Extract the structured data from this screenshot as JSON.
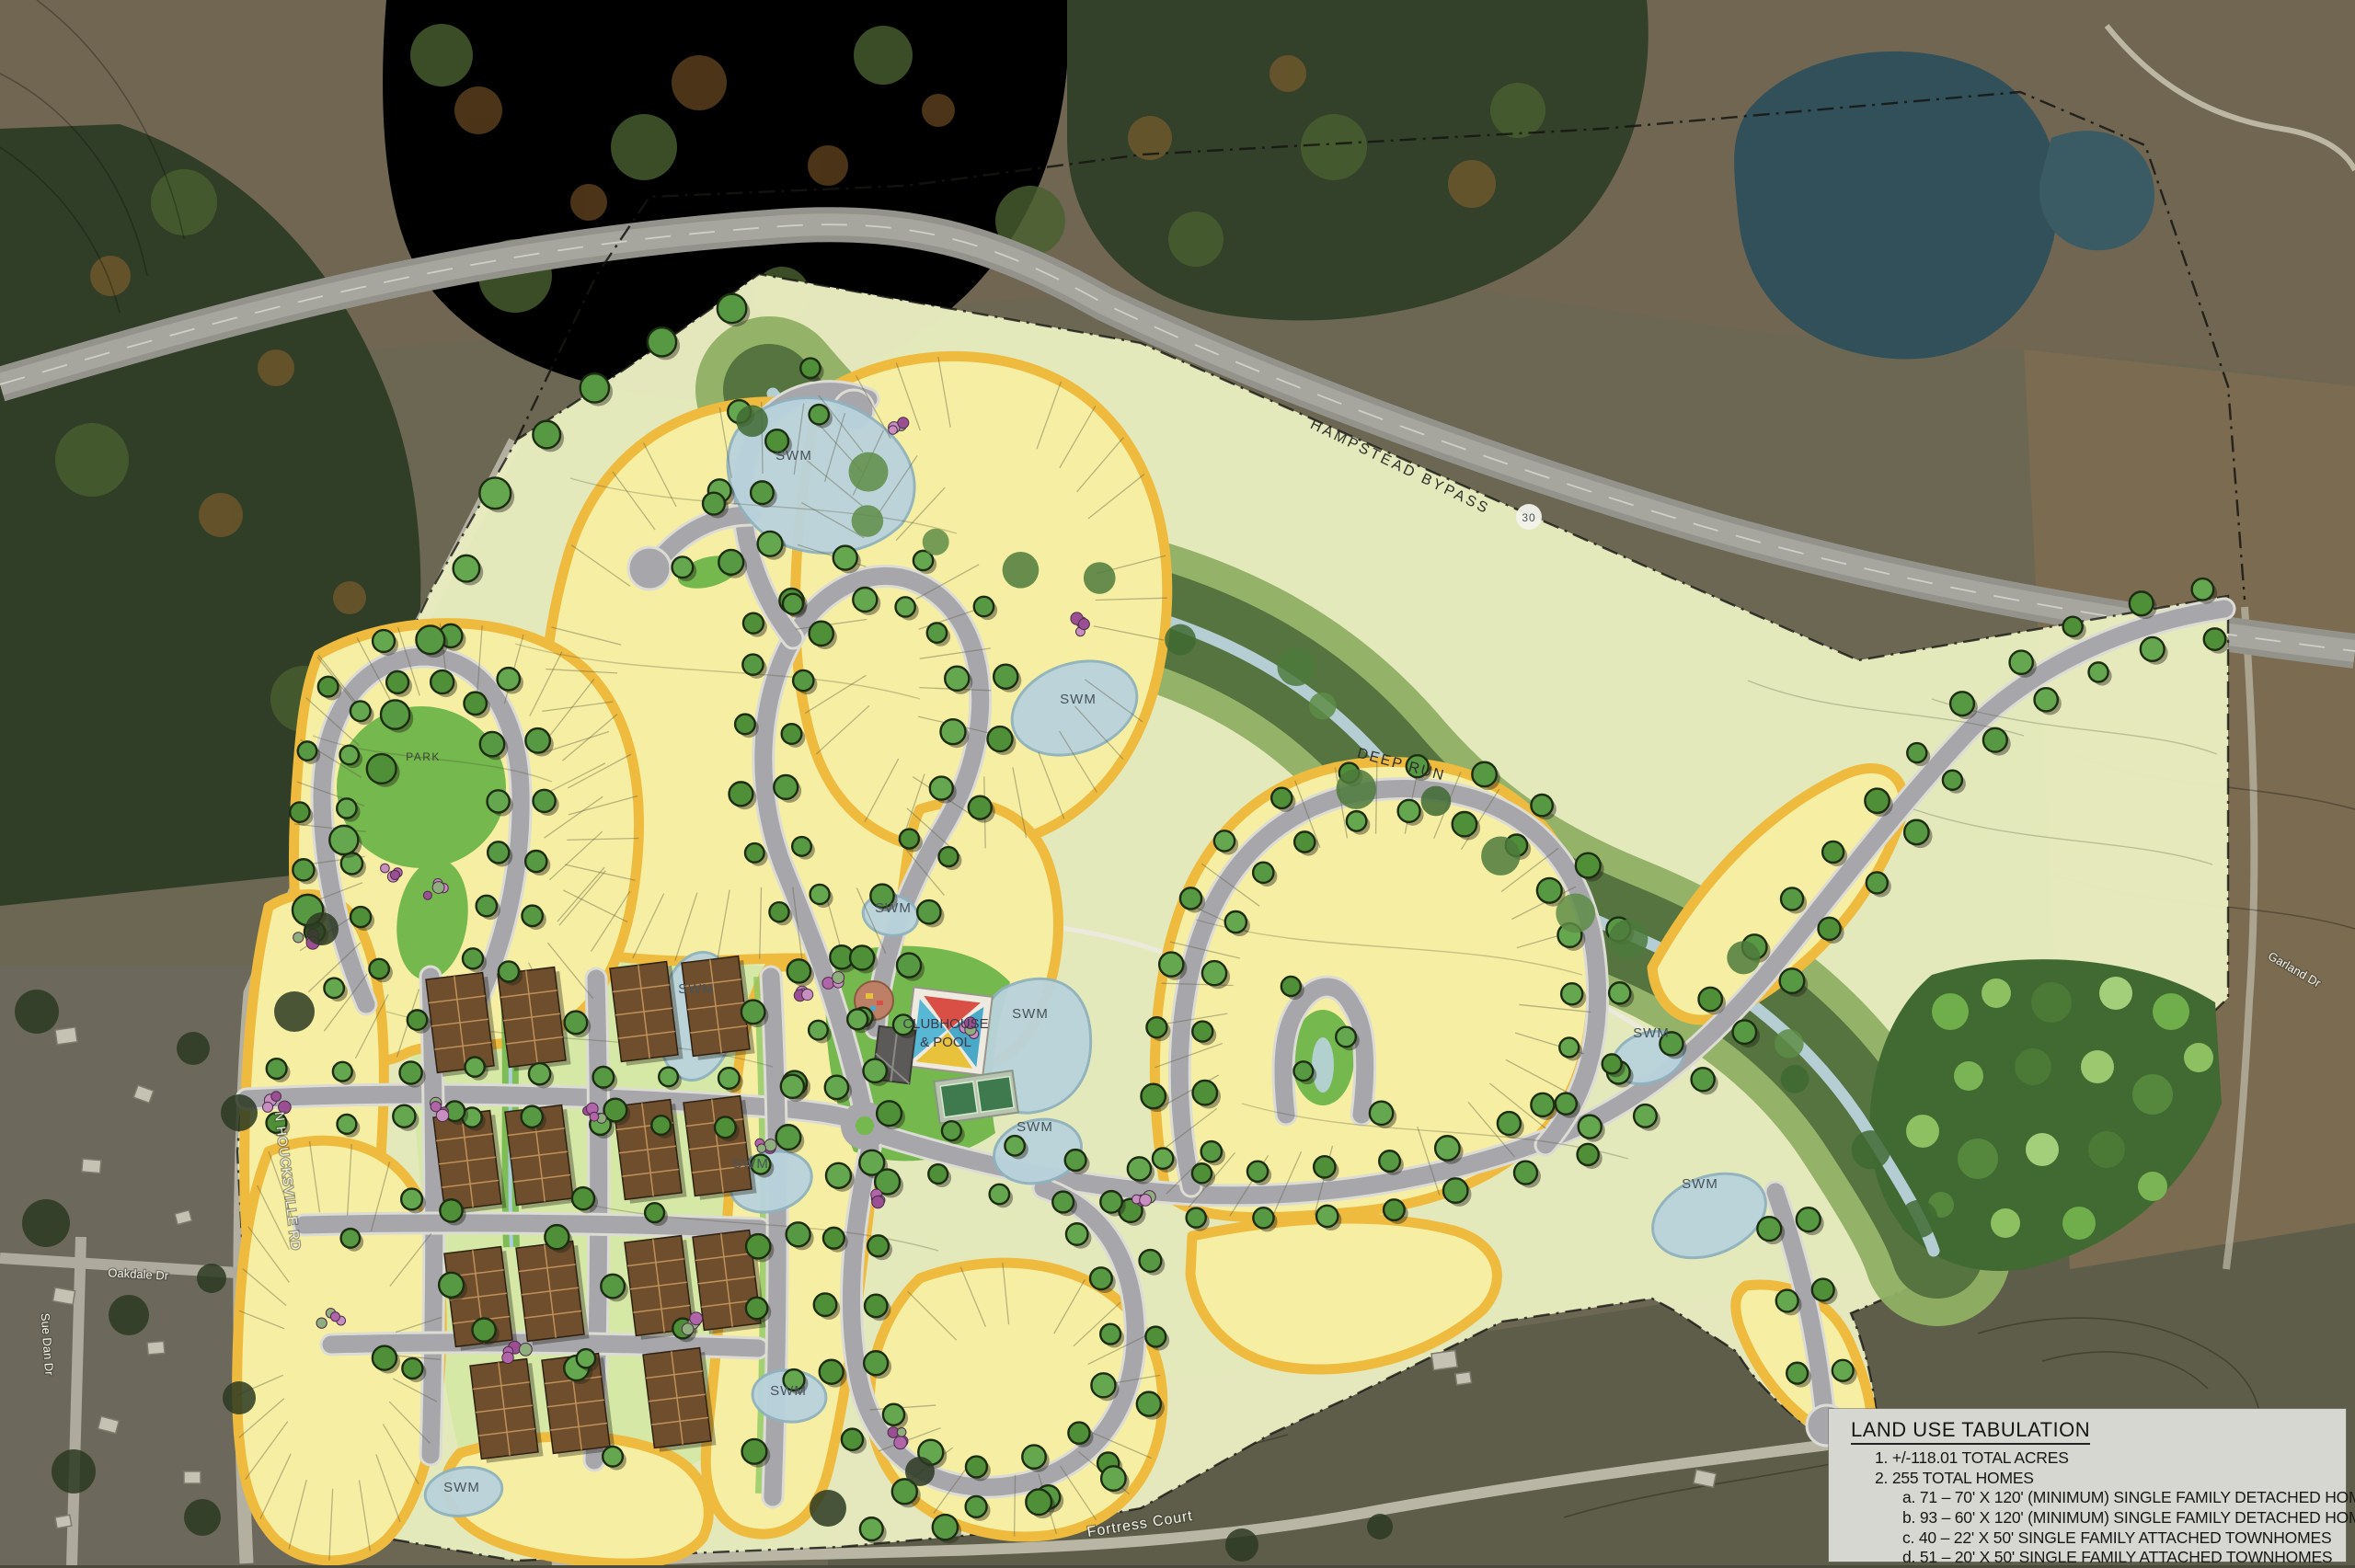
{
  "legend": {
    "title": "LAND USE TABULATION",
    "items": [
      {
        "text": "1. +/-118.01 TOTAL ACRES"
      },
      {
        "text": "2. 255 TOTAL HOMES"
      },
      {
        "text": "a. 71 – 70' X 120' (MINIMUM) SINGLE FAMILY DETACHED HOMES"
      },
      {
        "text": "b. 93 – 60' X 120' (MINIMUM) SINGLE FAMILY DETACHED HOMES"
      },
      {
        "text": "c. 40 – 22' X 50' SINGLE FAMILY ATTACHED TOWNHOMES"
      },
      {
        "text": "d. 51 – 20' X 50' SINGLE FAMILY ATTACHED TOWNHOMES"
      }
    ]
  },
  "map_labels": {
    "highway": "HAMPSTEAD BYPASS",
    "stream": "DEEP RUN",
    "park": "PARK",
    "clubhouse": [
      "CLUBHOUSE",
      "& POOL"
    ],
    "swm": "SWM",
    "swm_count": 11,
    "route_shield": "30",
    "roads": [
      "N HOUCKSVILLE RD",
      "Oakdale Dr",
      "Sue Dan Dr",
      "Fortress Court",
      "Garland Dr"
    ]
  },
  "colors": {
    "lot": "#f6efa3",
    "lot_edge": "#eebb3f",
    "road": "#a7a7ab",
    "road_edgeline": "#dcdcd4",
    "water": "#b9d3dc",
    "overlay": "#e7ebbe",
    "town_green": "#d6e8a6",
    "bright_green": "#74b84e",
    "woods": "#55743f",
    "open_green": "#8fb064",
    "townhome": "#6e4e2c",
    "tree": "#579843",
    "tree_outline": "#1c2d12",
    "legend_bg": "#d7d7d1",
    "bypass": "#93938c",
    "aerial_field": "#6b6753",
    "aerial_woods": "#2e3a26",
    "aerial_pond": "#31505a"
  }
}
